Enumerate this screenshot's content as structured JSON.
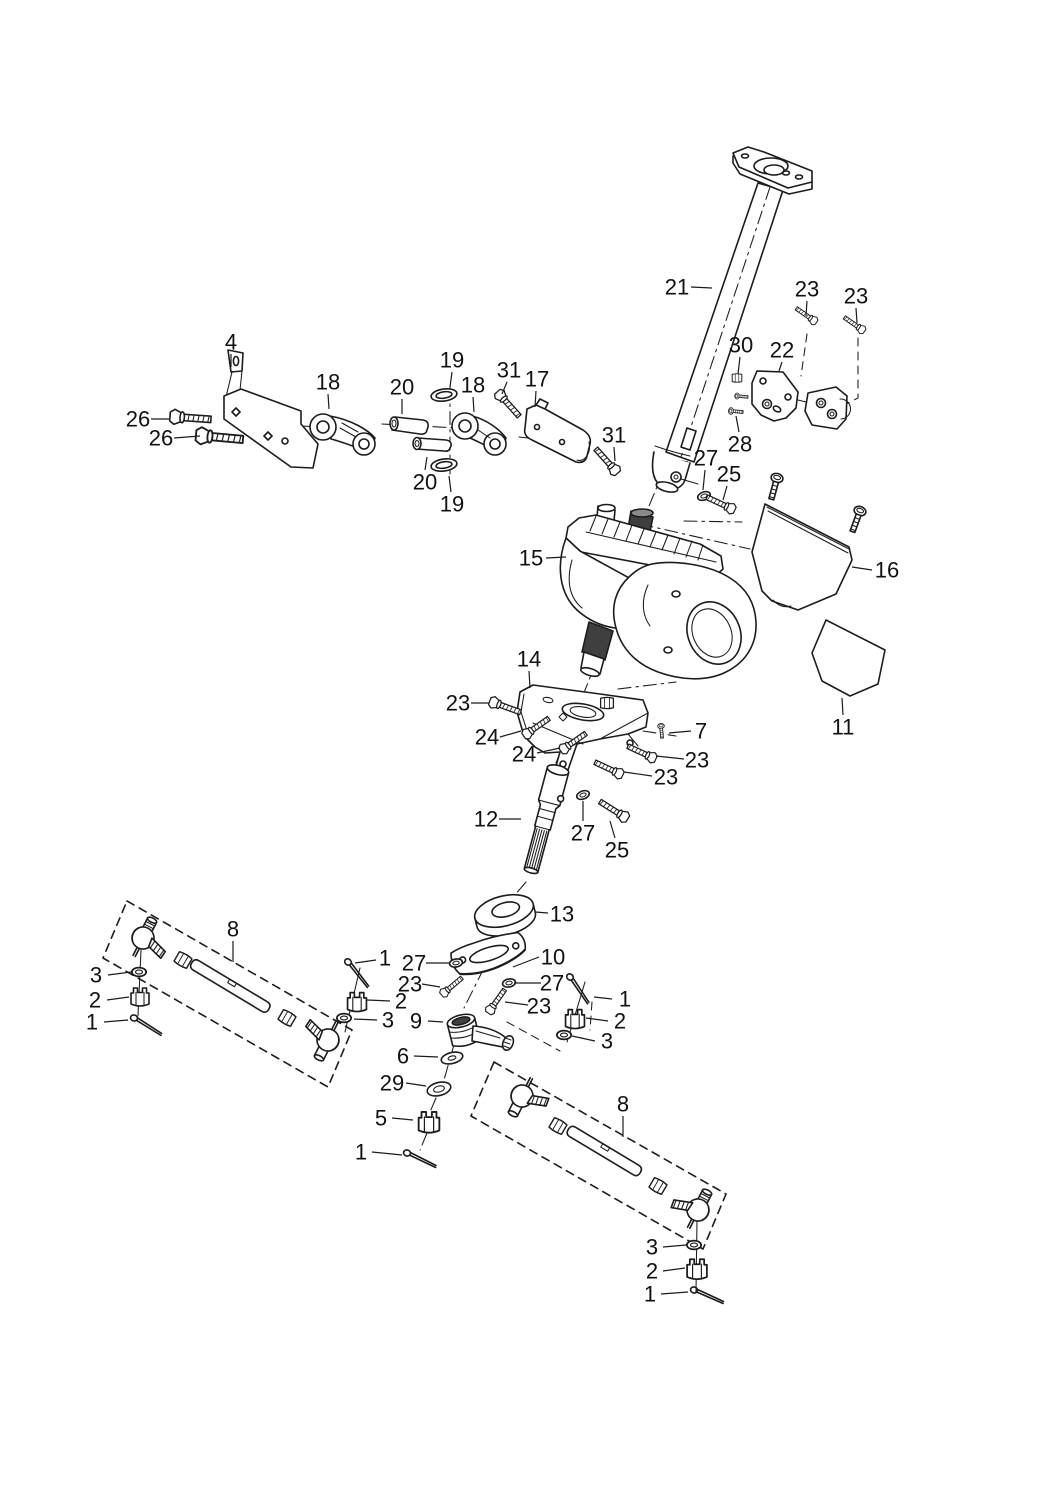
{
  "diagram": {
    "type": "exploded-parts-diagram",
    "subject": "steering-column-and-gear-assembly",
    "background": "#ffffff",
    "line_color": "#1c1c1c",
    "label_color": "#111111",
    "label_font_size": 22,
    "part_numbers_shown": [
      "1",
      "2",
      "3",
      "4",
      "5",
      "6",
      "7",
      "8",
      "9",
      "10",
      "11",
      "12",
      "13",
      "14",
      "15",
      "16",
      "17",
      "18",
      "19",
      "20",
      "21",
      "22",
      "23",
      "24",
      "25",
      "26",
      "27",
      "28",
      "29",
      "30",
      "31"
    ],
    "labels": [
      {
        "part": "21",
        "x": 677,
        "y": 287,
        "leader": [
          [
            691,
            287
          ],
          [
            712,
            288
          ]
        ]
      },
      {
        "part": "23",
        "x": 807,
        "y": 289,
        "leader": [
          [
            807,
            301
          ],
          [
            806,
            316
          ]
        ]
      },
      {
        "part": "23",
        "x": 856,
        "y": 296,
        "leader": [
          [
            856,
            308
          ],
          [
            857,
            323
          ]
        ]
      },
      {
        "part": "30",
        "x": 741,
        "y": 345,
        "leader": [
          [
            740,
            357
          ],
          [
            738,
            374
          ]
        ]
      },
      {
        "part": "22",
        "x": 782,
        "y": 350,
        "leader": [
          [
            782,
            362
          ],
          [
            779,
            371
          ]
        ]
      },
      {
        "part": "28",
        "x": 740,
        "y": 444,
        "leader": [
          [
            739,
            432
          ],
          [
            736,
            416
          ]
        ]
      },
      {
        "part": "4",
        "x": 231,
        "y": 342,
        "leader": [
          [
            231,
            354
          ],
          [
            231,
            367
          ]
        ]
      },
      {
        "part": "26",
        "x": 138,
        "y": 419,
        "leader": [
          [
            151,
            419
          ],
          [
            170,
            419
          ]
        ]
      },
      {
        "part": "26",
        "x": 161,
        "y": 438,
        "leader": [
          [
            174,
            438
          ],
          [
            200,
            436
          ]
        ]
      },
      {
        "part": "18",
        "x": 328,
        "y": 382,
        "leader": [
          [
            328,
            394
          ],
          [
            329,
            409
          ]
        ]
      },
      {
        "part": "20",
        "x": 402,
        "y": 387,
        "leader": [
          [
            402,
            399
          ],
          [
            402,
            414
          ]
        ]
      },
      {
        "part": "19",
        "x": 452,
        "y": 360,
        "leader": [
          [
            452,
            372
          ],
          [
            450,
            387
          ]
        ]
      },
      {
        "part": "18",
        "x": 473,
        "y": 385,
        "leader": [
          [
            473,
            397
          ],
          [
            474,
            412
          ]
        ]
      },
      {
        "part": "31",
        "x": 509,
        "y": 370,
        "leader": [
          [
            507,
            382
          ],
          [
            502,
            394
          ]
        ]
      },
      {
        "part": "17",
        "x": 537,
        "y": 379,
        "leader": [
          [
            536,
            391
          ],
          [
            535,
            407
          ]
        ]
      },
      {
        "part": "31",
        "x": 614,
        "y": 435,
        "leader": [
          [
            614,
            447
          ],
          [
            615,
            461
          ]
        ]
      },
      {
        "part": "20",
        "x": 425,
        "y": 482,
        "leader": [
          [
            425,
            470
          ],
          [
            427,
            457
          ]
        ]
      },
      {
        "part": "19",
        "x": 452,
        "y": 504,
        "leader": [
          [
            451,
            492
          ],
          [
            449,
            476
          ]
        ]
      },
      {
        "part": "27",
        "x": 706,
        "y": 458,
        "leader": [
          [
            705,
            470
          ],
          [
            703,
            490
          ]
        ]
      },
      {
        "part": "25",
        "x": 729,
        "y": 474,
        "leader": [
          [
            727,
            486
          ],
          [
            723,
            500
          ]
        ]
      },
      {
        "part": "15",
        "x": 531,
        "y": 558,
        "leader": [
          [
            546,
            558
          ],
          [
            566,
            557
          ]
        ]
      },
      {
        "part": "16",
        "x": 887,
        "y": 570,
        "leader": [
          [
            872,
            570
          ],
          [
            852,
            567
          ]
        ]
      },
      {
        "part": "11",
        "x": 843,
        "y": 727,
        "leader": [
          [
            843,
            715
          ],
          [
            842,
            698
          ]
        ]
      },
      {
        "part": "14",
        "x": 529,
        "y": 659,
        "leader": [
          [
            529,
            671
          ],
          [
            530,
            688
          ]
        ]
      },
      {
        "part": "23",
        "x": 458,
        "y": 703,
        "leader": [
          [
            471,
            703
          ],
          [
            489,
            703
          ]
        ]
      },
      {
        "part": "24",
        "x": 487,
        "y": 737,
        "leader": [
          [
            500,
            737
          ],
          [
            521,
            731
          ]
        ]
      },
      {
        "part": "24",
        "x": 524,
        "y": 754,
        "leader": [
          [
            537,
            753
          ],
          [
            560,
            748
          ]
        ]
      },
      {
        "part": "7",
        "x": 701,
        "y": 731,
        "leader": [
          [
            691,
            731
          ],
          [
            669,
            733
          ]
        ]
      },
      {
        "part": "23",
        "x": 697,
        "y": 760,
        "leader": [
          [
            684,
            759
          ],
          [
            656,
            756
          ]
        ]
      },
      {
        "part": "23",
        "x": 666,
        "y": 777,
        "leader": [
          [
            652,
            776
          ],
          [
            624,
            772
          ]
        ]
      },
      {
        "part": "12",
        "x": 486,
        "y": 819,
        "leader": [
          [
            499,
            819
          ],
          [
            521,
            819
          ]
        ]
      },
      {
        "part": "27",
        "x": 583,
        "y": 833,
        "leader": [
          [
            583,
            821
          ],
          [
            583,
            801
          ]
        ]
      },
      {
        "part": "25",
        "x": 617,
        "y": 850,
        "leader": [
          [
            615,
            838
          ],
          [
            610,
            821
          ]
        ]
      },
      {
        "part": "13",
        "x": 562,
        "y": 914,
        "leader": [
          [
            548,
            913
          ],
          [
            535,
            912
          ]
        ]
      },
      {
        "part": "10",
        "x": 553,
        "y": 957,
        "leader": [
          [
            539,
            957
          ],
          [
            513,
            967
          ]
        ]
      },
      {
        "part": "1",
        "x": 385,
        "y": 958,
        "leader": [
          [
            376,
            960
          ],
          [
            355,
            963
          ]
        ]
      },
      {
        "part": "27",
        "x": 414,
        "y": 963,
        "leader": [
          [
            426,
            963
          ],
          [
            449,
            963
          ]
        ]
      },
      {
        "part": "23",
        "x": 410,
        "y": 984,
        "leader": [
          [
            422,
            984
          ],
          [
            440,
            987
          ]
        ]
      },
      {
        "part": "2",
        "x": 401,
        "y": 1001,
        "leader": [
          [
            390,
            1001
          ],
          [
            367,
            1000
          ]
        ]
      },
      {
        "part": "3",
        "x": 388,
        "y": 1020,
        "leader": [
          [
            377,
            1020
          ],
          [
            354,
            1019
          ]
        ]
      },
      {
        "part": "9",
        "x": 416,
        "y": 1021,
        "leader": [
          [
            428,
            1021
          ],
          [
            443,
            1022
          ]
        ]
      },
      {
        "part": "1",
        "x": 625,
        "y": 999,
        "leader": [
          [
            612,
            999
          ],
          [
            594,
            997
          ]
        ]
      },
      {
        "part": "27",
        "x": 552,
        "y": 983,
        "leader": [
          [
            541,
            983
          ],
          [
            514,
            983
          ]
        ]
      },
      {
        "part": "23",
        "x": 539,
        "y": 1006,
        "leader": [
          [
            528,
            1005
          ],
          [
            505,
            1002
          ]
        ]
      },
      {
        "part": "2",
        "x": 620,
        "y": 1021,
        "leader": [
          [
            608,
            1021
          ],
          [
            586,
            1018
          ]
        ]
      },
      {
        "part": "3",
        "x": 607,
        "y": 1041,
        "leader": [
          [
            595,
            1041
          ],
          [
            572,
            1036
          ]
        ]
      },
      {
        "part": "6",
        "x": 403,
        "y": 1056,
        "leader": [
          [
            414,
            1056
          ],
          [
            438,
            1057
          ]
        ]
      },
      {
        "part": "29",
        "x": 392,
        "y": 1083,
        "leader": [
          [
            406,
            1083
          ],
          [
            426,
            1086
          ]
        ]
      },
      {
        "part": "5",
        "x": 381,
        "y": 1118,
        "leader": [
          [
            392,
            1118
          ],
          [
            413,
            1120
          ]
        ]
      },
      {
        "part": "1",
        "x": 361,
        "y": 1152,
        "leader": [
          [
            372,
            1152
          ],
          [
            402,
            1155
          ]
        ]
      },
      {
        "part": "8",
        "x": 233,
        "y": 929,
        "leader": [
          [
            233,
            941
          ],
          [
            233,
            962
          ]
        ]
      },
      {
        "part": "3",
        "x": 96,
        "y": 975,
        "leader": [
          [
            108,
            975
          ],
          [
            131,
            972
          ]
        ]
      },
      {
        "part": "2",
        "x": 95,
        "y": 1000,
        "leader": [
          [
            107,
            1000
          ],
          [
            129,
            997
          ]
        ]
      },
      {
        "part": "1",
        "x": 92,
        "y": 1022,
        "leader": [
          [
            104,
            1022
          ],
          [
            128,
            1020
          ]
        ]
      },
      {
        "part": "8",
        "x": 623,
        "y": 1104,
        "leader": [
          [
            623,
            1116
          ],
          [
            623,
            1137
          ]
        ]
      },
      {
        "part": "3",
        "x": 652,
        "y": 1247,
        "leader": [
          [
            663,
            1247
          ],
          [
            686,
            1245
          ]
        ]
      },
      {
        "part": "2",
        "x": 652,
        "y": 1271,
        "leader": [
          [
            663,
            1271
          ],
          [
            685,
            1268
          ]
        ]
      },
      {
        "part": "1",
        "x": 650,
        "y": 1294,
        "leader": [
          [
            661,
            1294
          ],
          [
            688,
            1292
          ]
        ]
      }
    ]
  }
}
